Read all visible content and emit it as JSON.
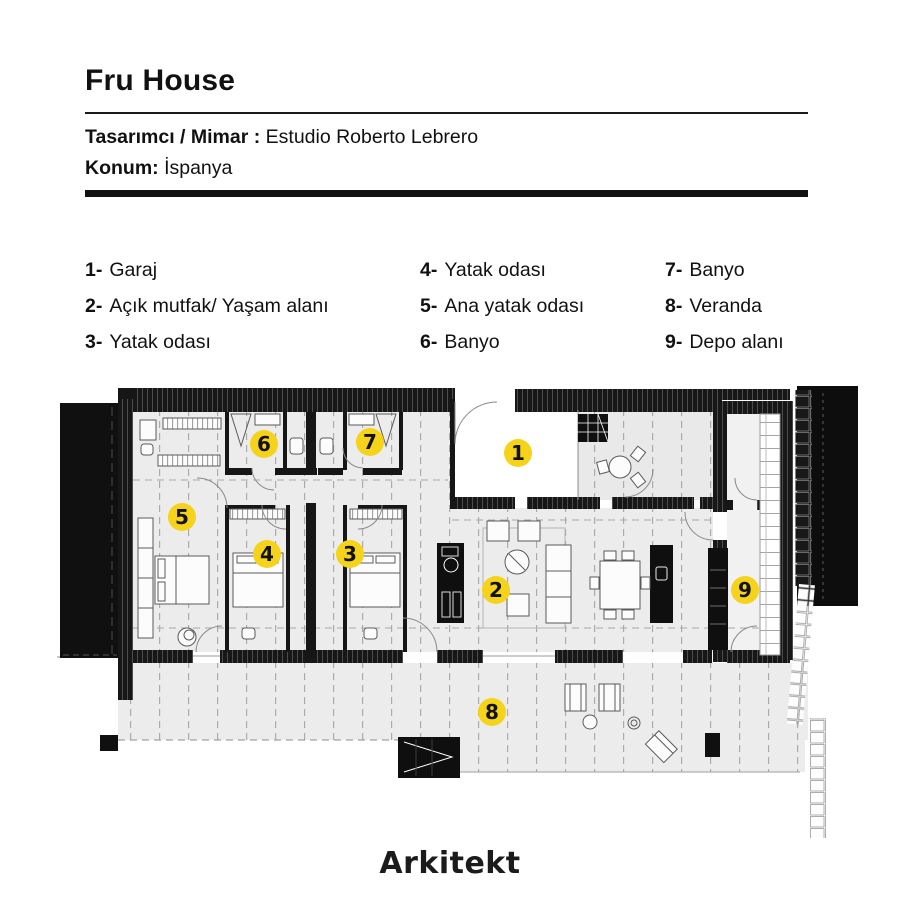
{
  "header": {
    "title": "Fru House",
    "designer_label": "Tasarımcı / Mimar :",
    "designer_value": "Estudio Roberto Lebrero",
    "location_label": "Konum:",
    "location_value": "İspanya"
  },
  "legend": {
    "items": [
      {
        "num": "1-",
        "label": "Garaj"
      },
      {
        "num": "2-",
        "label": "Açık mutfak/ Yaşam alanı"
      },
      {
        "num": "3-",
        "label": "Yatak odası"
      },
      {
        "num": "4-",
        "label": "Yatak odası"
      },
      {
        "num": "5-",
        "label": "Ana yatak odası"
      },
      {
        "num": "6-",
        "label": "Banyo"
      },
      {
        "num": "7-",
        "label": "Banyo"
      },
      {
        "num": "8-",
        "label": "Veranda"
      },
      {
        "num": "9-",
        "label": "Depo alanı"
      }
    ]
  },
  "plan": {
    "marker_color": "#F5D31A",
    "marker_text_color": "#121212",
    "markers": [
      {
        "n": "1",
        "x": 518,
        "y": 453
      },
      {
        "n": "2",
        "x": 496,
        "y": 590
      },
      {
        "n": "3",
        "x": 350,
        "y": 554
      },
      {
        "n": "4",
        "x": 267,
        "y": 554
      },
      {
        "n": "5",
        "x": 182,
        "y": 517
      },
      {
        "n": "6",
        "x": 264,
        "y": 444
      },
      {
        "n": "7",
        "x": 370,
        "y": 442
      },
      {
        "n": "8",
        "x": 492,
        "y": 712
      },
      {
        "n": "9",
        "x": 745,
        "y": 590
      }
    ]
  },
  "footer": {
    "logo_text": "Arkitekt"
  },
  "colors": {
    "accent_yellow": "#F5D31A",
    "wall": "#161616",
    "floor": "#ECECEC"
  }
}
